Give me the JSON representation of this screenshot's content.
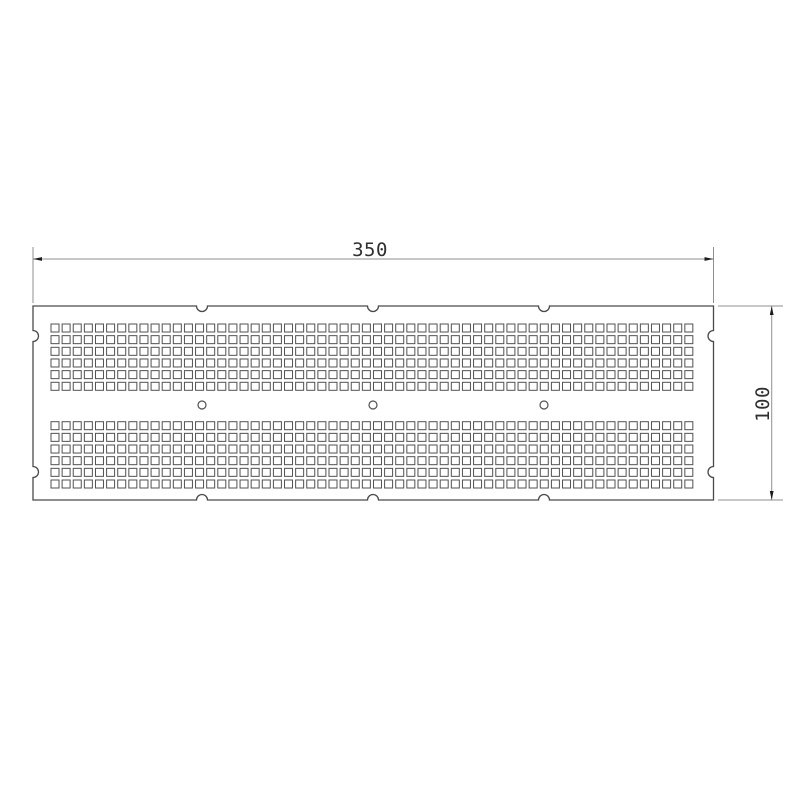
{
  "drawing": {
    "type": "technical-drawing",
    "part": "perforated-plate",
    "canvas": {
      "width": 800,
      "height": 800
    },
    "colors": {
      "background": "#ffffff",
      "outline": "#4a4a4a",
      "holes": "#515151",
      "dimension_lines": "#8f8f8f",
      "dimension_text": "#2f2f2f",
      "arrows": "#1c1c1c"
    },
    "plate": {
      "x": 33,
      "y": 306,
      "width": 680.5,
      "height": 194,
      "edge_notches": {
        "radius": 5.5,
        "top_x": [
          202,
          373,
          544
        ],
        "bottom_x": [
          202,
          373,
          544
        ],
        "left_y": [
          336,
          472
        ],
        "right_y": [
          336,
          472
        ]
      }
    },
    "hole_grid": {
      "square_size": 8,
      "columns": 58,
      "rows_per_band": 6,
      "origin_x": 51,
      "pitch_x": 11.12,
      "pitch_y": 11.66,
      "band_origins_y": [
        324,
        421.7
      ]
    },
    "round_holes": {
      "count": 3,
      "centers_x": [
        202,
        373,
        544
      ],
      "center_y": 405,
      "radius": 4
    },
    "dimensions": {
      "width": {
        "label": "350",
        "line_y": 259,
        "x1": 33,
        "x2": 713.5,
        "ext_top": 247,
        "ext_bottom": 303,
        "text_x": 370,
        "text_y": 256
      },
      "height": {
        "label": "100",
        "line_x": 771.7,
        "y1": 306,
        "y2": 500,
        "ext_x1": 718,
        "ext_x2": 783,
        "text_x": 769,
        "text_y": 404
      }
    },
    "arrow": {
      "length": 9,
      "half_width": 1.9
    }
  }
}
